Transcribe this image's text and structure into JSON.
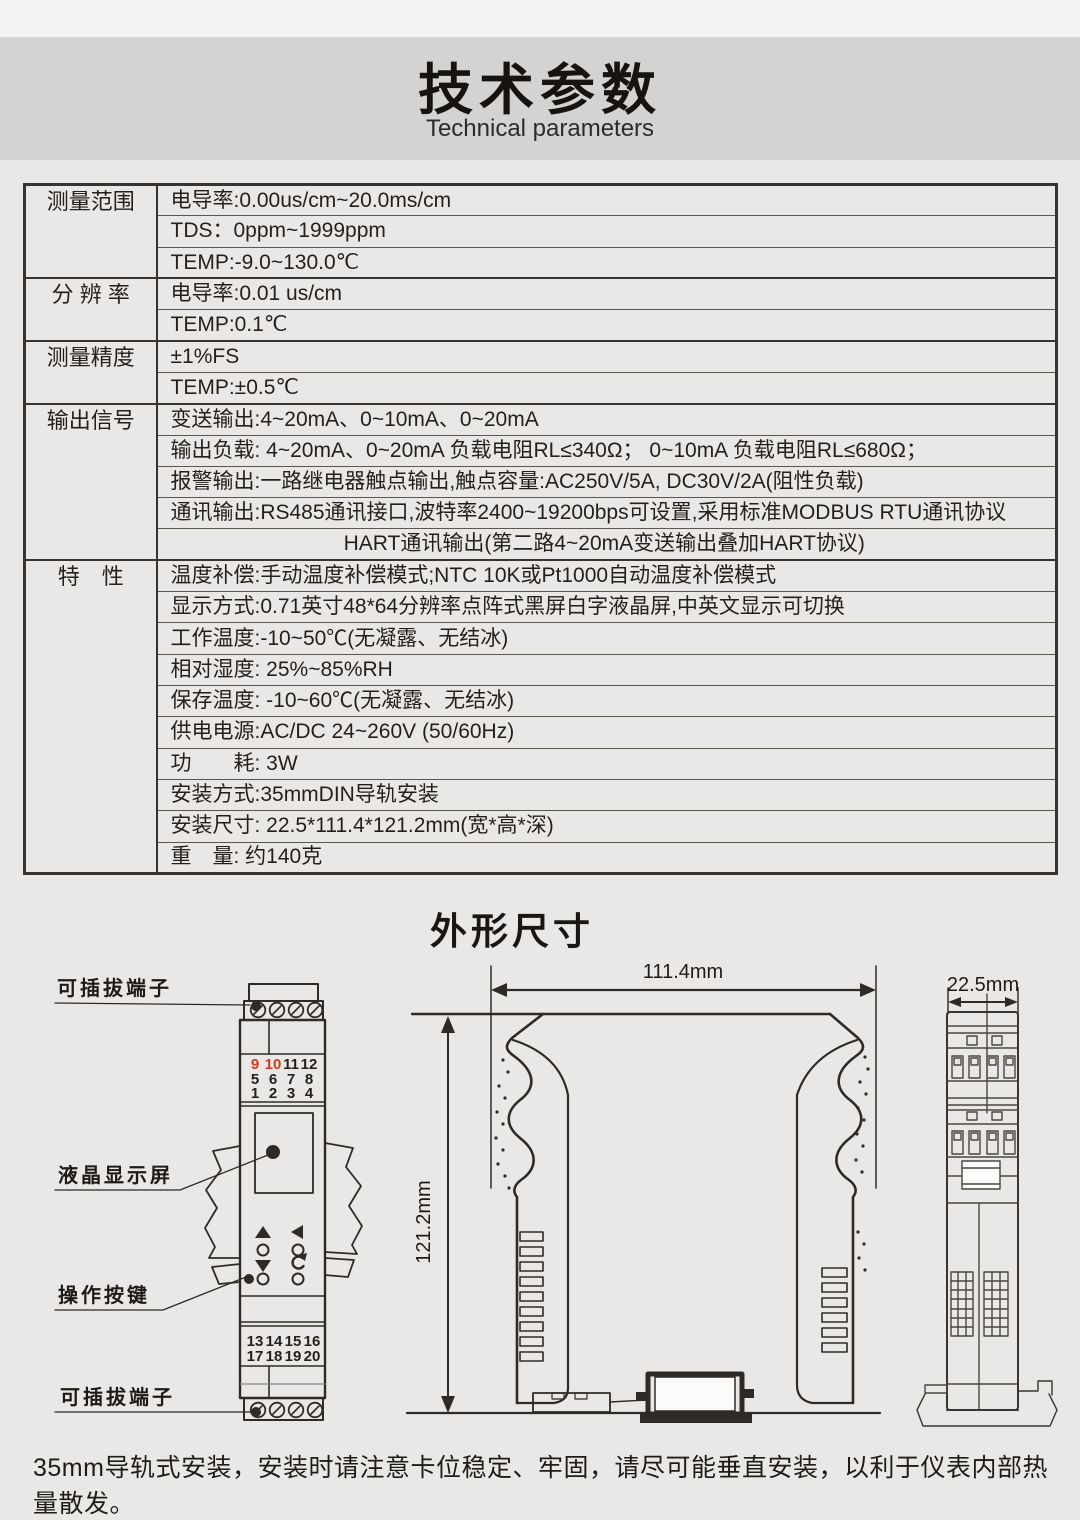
{
  "page": {
    "title": "技术参数",
    "subtitle": "Technical parameters",
    "section2_title": "外形尺寸",
    "footnote": "35mm导轨式安装，安装时请注意卡位稳定、牢固，请尽可能垂直安装，以利于仪表内部热量散发。"
  },
  "colors": {
    "accent_red": "#d23a20",
    "line_dark": "#2f2a25",
    "banner_bg": "#d4d3d1",
    "page_bg": "#eae8e6"
  },
  "table": {
    "groups": [
      {
        "label": "测量范围",
        "rows": [
          "电导率:0.00us/cm~20.0ms/cm",
          "TDS：0ppm~1999ppm",
          "TEMP:-9.0~130.0℃"
        ]
      },
      {
        "label": "分 辨 率",
        "rows": [
          "电导率:0.01 us/cm",
          "TEMP:0.1℃"
        ]
      },
      {
        "label": "测量精度",
        "rows": [
          "±1%FS",
          "TEMP:±0.5℃"
        ]
      },
      {
        "label": "输出信号",
        "rows": [
          "变送输出:4~20mA、0~10mA、0~20mA",
          "输出负载: 4~20mA、0~20mA 负载电阻RL≤340Ω； 0~10mA 负载电阻RL≤680Ω；",
          "报警输出:一路继电器触点输出,触点容量:AC250V/5A, DC30V/2A(阻性负载)",
          "通讯输出:RS485通讯接口,波特率2400~19200bps可设置,采用标准MODBUS RTU通讯协议",
          "HART通讯输出(第二路4~20mA变送输出叠加HART协议)"
        ]
      },
      {
        "label": "特　性",
        "rows": [
          "温度补偿:手动温度补偿模式;NTC 10K或Pt1000自动温度补偿模式",
          "显示方式:0.71英寸48*64分辨率点阵式黑屏白字液晶屏,中英文显示可切换",
          "工作温度:-10~50℃(无凝露、无结冰)",
          "相对湿度: 25%~85%RH",
          "保存温度: -10~60℃(无凝露、无结冰)",
          "供电电源:AC/DC 24~260V (50/60Hz)",
          "功　　耗: 3W",
          "安装方式:35mmDIN导轨安装",
          "安装尺寸: 22.5*111.4*121.2mm(宽*高*深)",
          "重　量: 约140克"
        ]
      }
    ]
  },
  "drawing": {
    "callouts": {
      "top": "可插拔端子",
      "lcd": "液晶显示屏",
      "keys": "操作按键",
      "bottom": "可插拔端子"
    },
    "dims": {
      "w": "111.4mm",
      "h": "121.2mm",
      "d": "22.5mm"
    },
    "front": {
      "term_top": [
        "9",
        "10",
        "11",
        "12",
        "5",
        "6",
        "7",
        "8",
        "1",
        "2",
        "3",
        "4"
      ],
      "term_bottom": [
        "13",
        "14",
        "15",
        "16",
        "17",
        "18",
        "19",
        "20"
      ]
    }
  }
}
